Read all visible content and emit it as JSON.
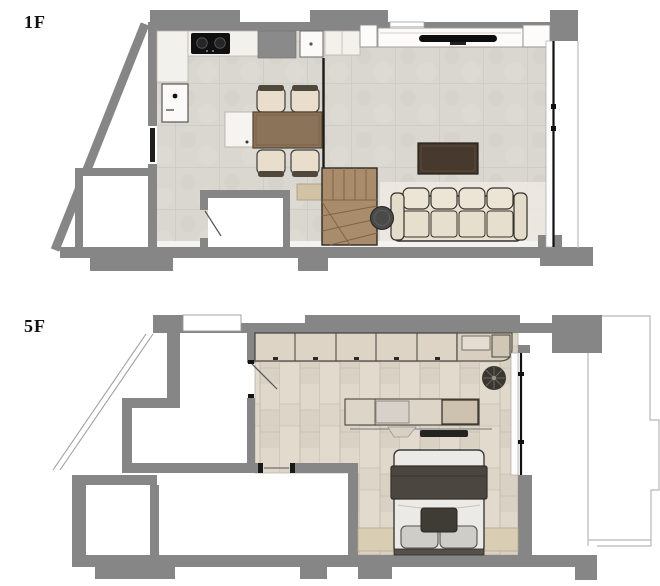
{
  "title": "Two-floor apartment floor plan",
  "floors": [
    {
      "label": "1F",
      "rooms": [
        "kitchen-dining",
        "living-room",
        "entry-corridor",
        "storage-room-a",
        "storage-room-b",
        "staircase",
        "balcony"
      ],
      "furniture": [
        "kitchen-counter",
        "cooktop-2-burner",
        "sink-unit",
        "refrigerator-column",
        "dishwasher",
        "kitchen-island",
        "dining-table",
        "dining-chairs-x4",
        "media-console",
        "tv",
        "coffee-table",
        "sofa-4-seat",
        "round-side-table",
        "stairs-to-upper-floor",
        "entry-door",
        "balcony-sliding-door"
      ]
    },
    {
      "label": "5F",
      "rooms": [
        "bedroom",
        "walkway",
        "void-left",
        "small-room",
        "terrace"
      ],
      "furniture": [
        "wardrobe-row-5-units",
        "corner-counter",
        "potted-plant",
        "desk-console",
        "keyboard",
        "double-bed",
        "blanket",
        "pillows-x2",
        "bed-cushion",
        "headboard-shelf",
        "room-door",
        "terrace-outline"
      ]
    }
  ],
  "palette": {
    "wall_gray": "#868686",
    "black_partition": "#1a1a1a",
    "tile_floor": "#dad6d0",
    "wood_floor": "#ded7ca",
    "stair_wood": "#a98c6b",
    "cabinet_beige": "#ddd4c6",
    "sofa_cream": "#e9e2d2",
    "dining_table_brown": "#8a7358",
    "coffee_table_brown": "#463a2e",
    "appliance_black": "#0d0d0d",
    "outline_thin": "#b8b8b8"
  }
}
